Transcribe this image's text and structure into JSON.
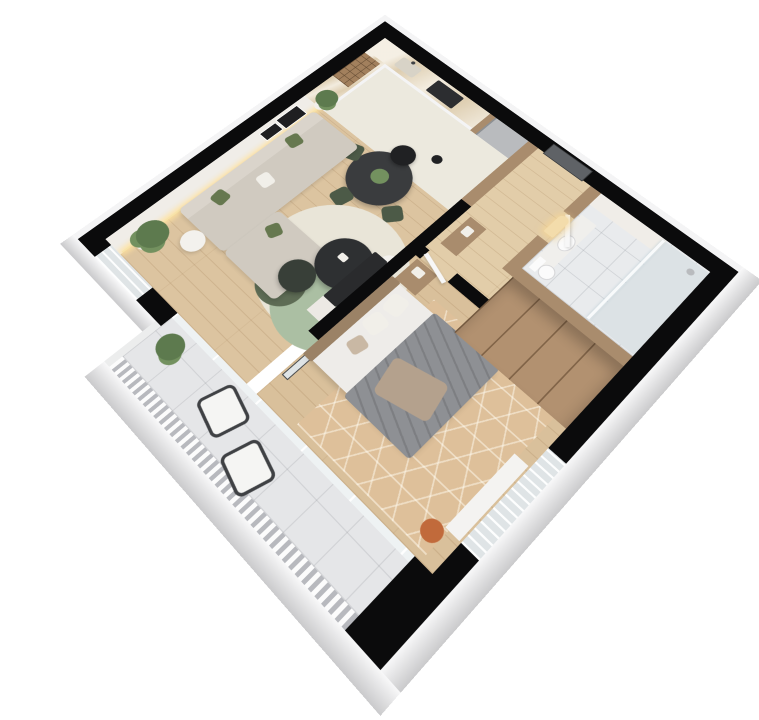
{
  "scene": {
    "kind": "3d-isometric-floor-plan-render",
    "background": "#ffffff",
    "rooms": [
      {
        "name": "kitchen-dining",
        "floor": "cream stone tile"
      },
      {
        "name": "living-room",
        "floor": "light oak planks"
      },
      {
        "name": "entry-hall",
        "floor": "light oak planks"
      },
      {
        "name": "bathroom",
        "floor": "white tile"
      },
      {
        "name": "bedroom",
        "floor": "light oak planks with hex rug"
      },
      {
        "name": "balcony",
        "floor": "light grey tile"
      }
    ],
    "furniture": {
      "kitchen": [
        "l-shaped-white-counter",
        "marble-worktop",
        "sink",
        "black-cooktop",
        "fridge",
        "wall-wine-rack",
        "round-dark-dining-table",
        "green-dining-chairs",
        "black-dome-pendants"
      ],
      "living": [
        "l-shaped-beige-sofa",
        "green-pillows",
        "round-charcoal-coffee-tables",
        "layered-round-rug",
        "white-side-tables",
        "monstera-plant",
        "fiddle-leaf-plant",
        "tv-partition-unit",
        "leaning-picture-frames",
        "led-wall-strip"
      ],
      "hall": [
        "dark-grey-entry-door",
        "wood-console"
      ],
      "bathroom": [
        "vanity-with-arched-lit-mirror",
        "toilet",
        "glass-shower",
        "wood-panel-walls"
      ],
      "bedroom": [
        "double-bed-grey-blanket",
        "wood-headboard",
        "bedside-shelf",
        "large-wood-wardrobe",
        "hex-pattern-rug",
        "white-window-console",
        "terracotta-pouf",
        "leaning-mirror"
      ],
      "balcony": [
        "two-lounge-chairs",
        "monstera-plant",
        "slatted-railing",
        "glass-sliding-doors"
      ]
    }
  },
  "palette": {
    "pageBg": "#ffffff",
    "wall": "#0b0b0c",
    "facade": "#ebebed",
    "facadeLight": "#f4f4f5",
    "wallFace": "#f0ede8",
    "ledStrip": "#f7e3a9",
    "frameDark": "#1f1f21",
    "floorLiving": "#dcc4a0",
    "floorKitchen": "#ece9de",
    "floorHall": "#e2cda9",
    "floorBath": "#e9ebed",
    "floorBedroom": "#d9c09b",
    "floorBalcony": "#e5e6e8",
    "counterWhite": "#f4f4f5",
    "counterMarble": "#e8dcc4",
    "cooktop": "#2c2d30",
    "sink": "#d8d3c7",
    "fridge": "#b9bbbe",
    "woodPanel": "#a98c6d",
    "wineShelf": "#a2805d",
    "pendant": "#202123",
    "diningTable": "#3a3c3e",
    "chairGreen": "#4c5a47",
    "sofa": "#d0cac0",
    "sofaBack": "#dad4cb",
    "pillowGreen": "#66784f",
    "pillowWhite": "#f1efe9",
    "rugCream": "#e9e5d8",
    "rugSage": "#abbfa3",
    "rugDark": "#5e6c55",
    "tableCharcoal": "#2e3032",
    "tableGreenDark": "#383f38",
    "sideTable": "#f3f1ed",
    "plant": "#5d7a4e",
    "plantLight": "#73915f",
    "pot": "#f1efeb",
    "tvDark": "#2a2b2d",
    "tvShelf": "#ece9e4",
    "doorEntry": "#5f6266",
    "doorWhite": "#f7f7f7",
    "wardrobe": "#b29170",
    "headboard": "#9b8266",
    "mattress": "#eeece9",
    "blanket": "#8e9094",
    "throw": "#b4a18d",
    "pillowTaupe": "#c9b8a4",
    "rugHex": "#dec09a",
    "pouf": "#c16a3b",
    "consoleWhite": "#f4f3f1",
    "vanity": "#f0efec",
    "toilet": "#fbfbfb",
    "showerFloor": "#dce2e5",
    "showerGlass": "#f8fafb",
    "mirrorGlow": "#f3dcab",
    "balconyChair": "#f5f5f3",
    "chairFrame": "#3f4144",
    "railBase": "#d4d5d8",
    "windowGlass": "#dfe4e6",
    "glassDoor": "#eef2f3",
    "balconyWallWhite": "#eceded"
  }
}
